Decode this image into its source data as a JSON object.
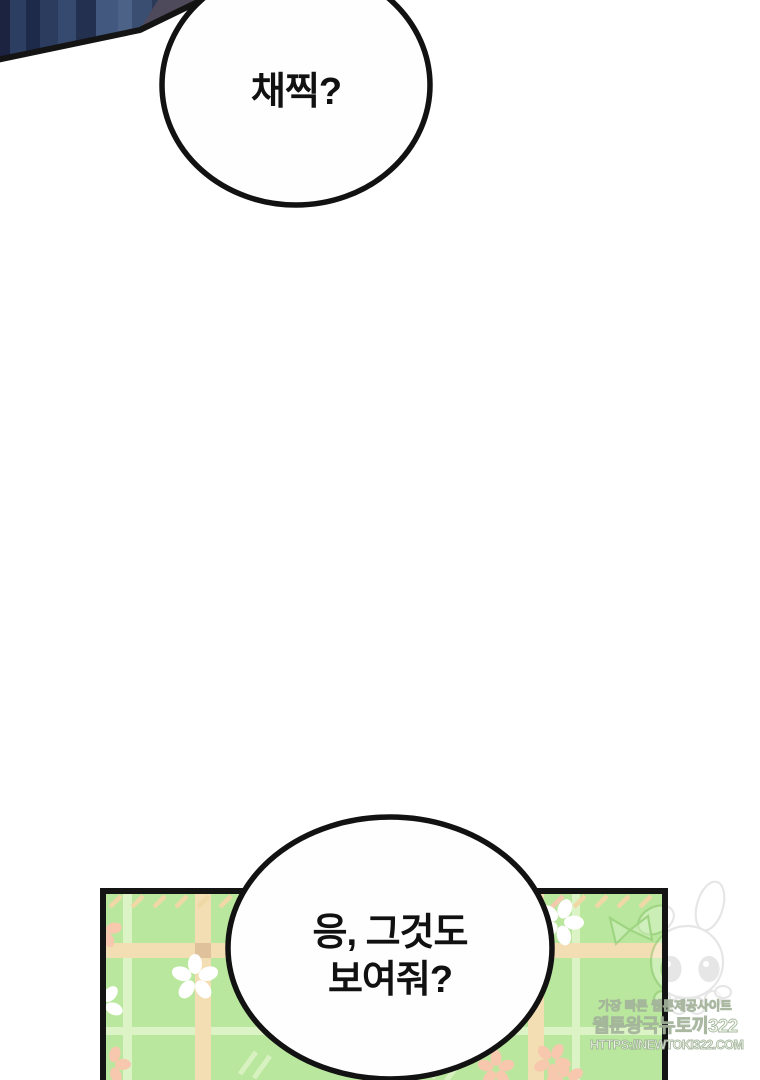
{
  "page": {
    "type": "webtoon-episode-panel",
    "background": "#ffffff"
  },
  "bubble_top": {
    "text": "채찍?"
  },
  "bubble_bottom": {
    "line1": "응, 그것도",
    "line2": "보여줘?"
  },
  "watermark": {
    "line1": "가장 빠른 웹툰제공사이트",
    "line2": "웹툰왕국뉴토끼322",
    "line3": "HTTPS://NEWTOKI322.COM"
  },
  "colors": {
    "artwork_navy_dark": "#1e2944",
    "artwork_navy_mid": "#2e4164",
    "artwork_navy_light": "#46597e",
    "artwork_gray_purple": "#4e4a5c",
    "outline_black": "#141414",
    "bubble_fill": "#fefefe",
    "panel_green_base": "#b9e79d",
    "panel_stripe_tan": "#f3ddb2",
    "panel_stripe_tan_dark": "#dfc29b",
    "panel_stripe_pale": "#dcf3c6",
    "flower_white": "#ffffff",
    "flower_peach": "#f7c8ad",
    "watermark_text": "#f7fcf3"
  }
}
